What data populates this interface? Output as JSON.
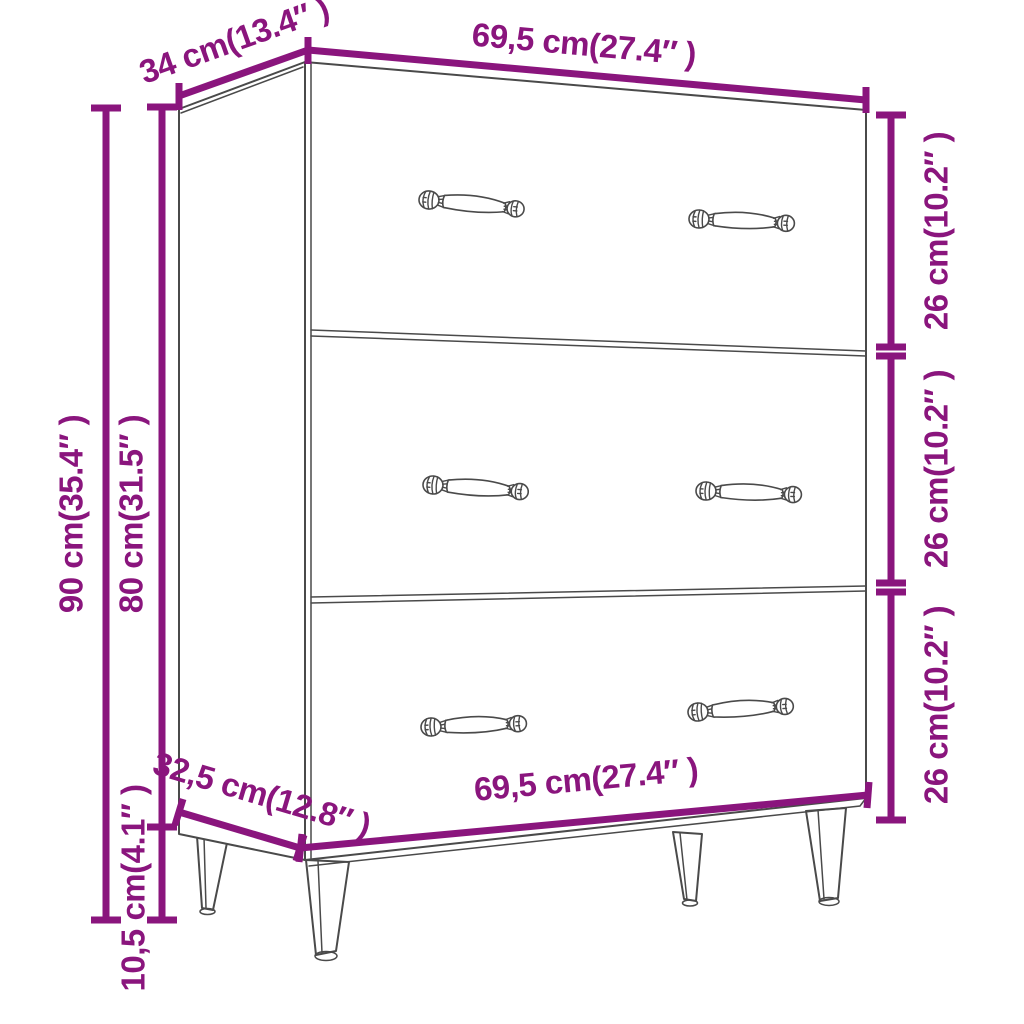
{
  "page": {
    "background": "#ffffff",
    "description": "Product dimension diagram of a sideboard with three drawers and four tapered legs, drawn as grey line art with magenta measurement lines"
  },
  "colors": {
    "dimension_accent": "#8A157D",
    "drawing_line": "#4A4A4A"
  },
  "dimensions": {
    "depth_top": "34 cm(13.4″ )",
    "width_top": "69,5 cm(27.4″ )",
    "height_total": "90 cm(35.4″ )",
    "height_body": "80 cm(31.5″ )",
    "height_legs": "10,5 cm(4.1″ )",
    "drawer_top": "26 cm(10.2″ )",
    "drawer_middle": "26 cm(10.2″ )",
    "drawer_bottom": "26 cm(10.2″ )",
    "depth_bottom": "32,5 cm(12.8″ )",
    "width_bottom": "69,5 cm(27.4″ )"
  }
}
